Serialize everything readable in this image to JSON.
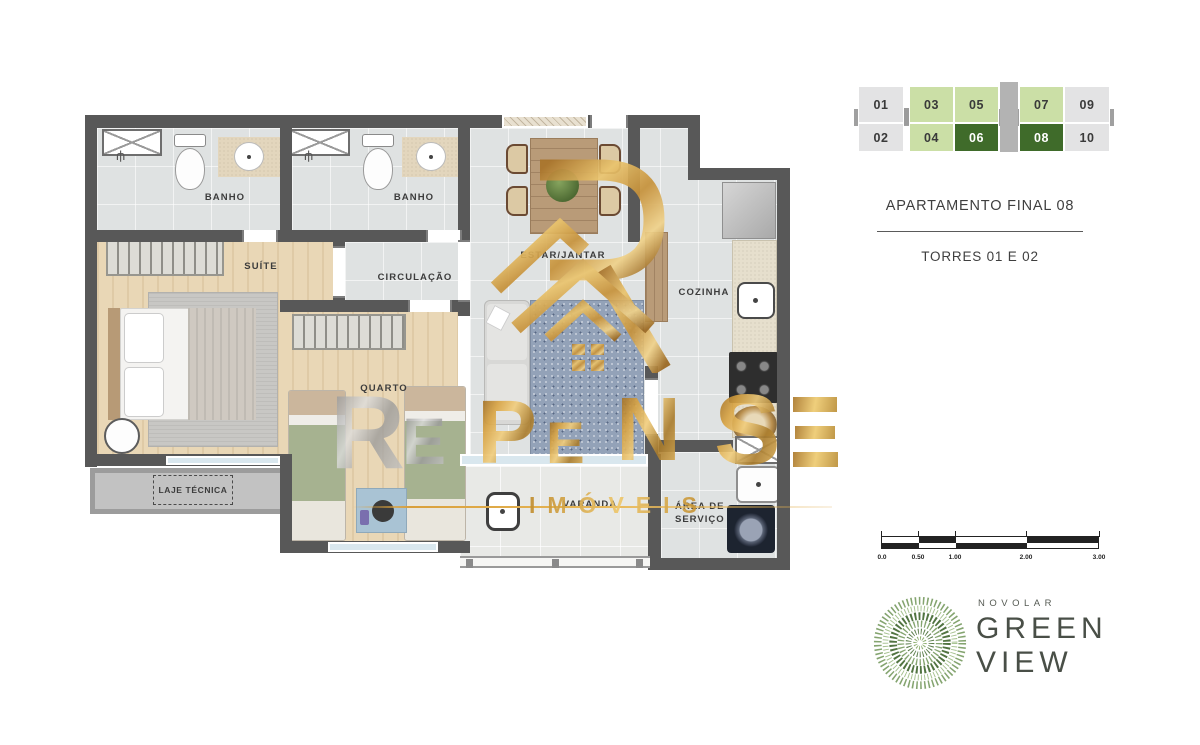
{
  "plan": {
    "labels": {
      "banho1": "BANHO",
      "banho2": "BANHO",
      "suite": "SUÍTE",
      "circulacao": "CIRCULAÇÃO",
      "quarto": "QUARTO",
      "estar": "ESTAR/JANTAR",
      "cozinha": "COZINHA",
      "varanda": "VARANDA",
      "servico_line1": "ÁREA DE",
      "servico_line2": "SERVIÇO",
      "laje": "LAJE TÉCNICA"
    }
  },
  "watermark": {
    "word": "REPENSE",
    "letters": [
      "R",
      "E",
      "P",
      "E",
      "N",
      "S",
      "E"
    ],
    "imoveis": "IMÓVEIS",
    "gold": "#d9a847",
    "silver": "#b5b5b5"
  },
  "panel": {
    "building": {
      "units": [
        {
          "id": "01",
          "tone": "gray"
        },
        {
          "id": "02",
          "tone": "gray"
        },
        {
          "id": "03",
          "tone": "light"
        },
        {
          "id": "04",
          "tone": "light"
        },
        {
          "id": "05",
          "tone": "light"
        },
        {
          "id": "06",
          "tone": "dark"
        },
        {
          "id": "07",
          "tone": "light"
        },
        {
          "id": "08",
          "tone": "dark"
        },
        {
          "id": "09",
          "tone": "gray"
        },
        {
          "id": "10",
          "tone": "gray"
        }
      ]
    },
    "title": "APARTAMENTO FINAL 08",
    "subtitle": "TORRES 01 E 02",
    "scale": {
      "labels": [
        "0.0",
        "0.50",
        "1.00",
        "2.00",
        "3.00"
      ]
    },
    "logo": {
      "brand": "NOVOLAR",
      "name_line1": "GREEN",
      "name_line2": "VIEW",
      "green": "#4d7a3c"
    }
  }
}
